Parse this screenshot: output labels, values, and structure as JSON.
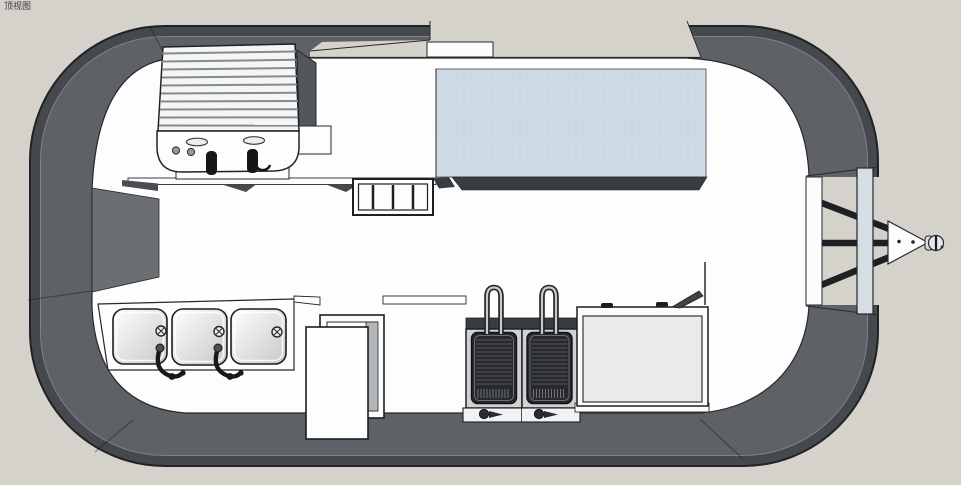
{
  "viewport": {
    "label": "顶视图",
    "view": "top",
    "application_style": "SketchUp-like 3D viewport"
  },
  "scene": {
    "subject": "concession food trailer floor plan, top view",
    "objects": [
      {
        "id": "trailer-shell",
        "label": "rounded trailer body shell"
      },
      {
        "id": "griddle",
        "label": "ribbed griddle unit with two black knobs"
      },
      {
        "id": "serving-window-glass",
        "label": "light blue serving window / counter glass"
      },
      {
        "id": "tray-rack",
        "label": "four-slot tray rack on counter edge"
      },
      {
        "id": "sink-unit",
        "label": "three-compartment sink with two faucets",
        "sink_count": 3,
        "faucet_count": 2
      },
      {
        "id": "entry-door",
        "label": "open entry door with frame"
      },
      {
        "id": "fryer-station",
        "label": "double deep fryer with baskets and handles",
        "fryer_count": 2
      },
      {
        "id": "chest-counter",
        "label": "flat-top chest counter appliance"
      },
      {
        "id": "hitch-assembly",
        "label": "A-frame tow hitch with coupler ball"
      },
      {
        "id": "rear-bumper",
        "label": "vertical bumper bar"
      }
    ]
  },
  "colors": {
    "background": "#d4d2cb",
    "shell_outer_band": "#45484c",
    "shell_inner_band": "#5e6166",
    "interior_floor": "#fdfdfd",
    "window_glass": "#cdd9e4",
    "counter_front_edge": "#3a3d40",
    "equipment_dark": "#27292c",
    "outline": "#202224",
    "bumper_bar": "#d6dee6"
  }
}
